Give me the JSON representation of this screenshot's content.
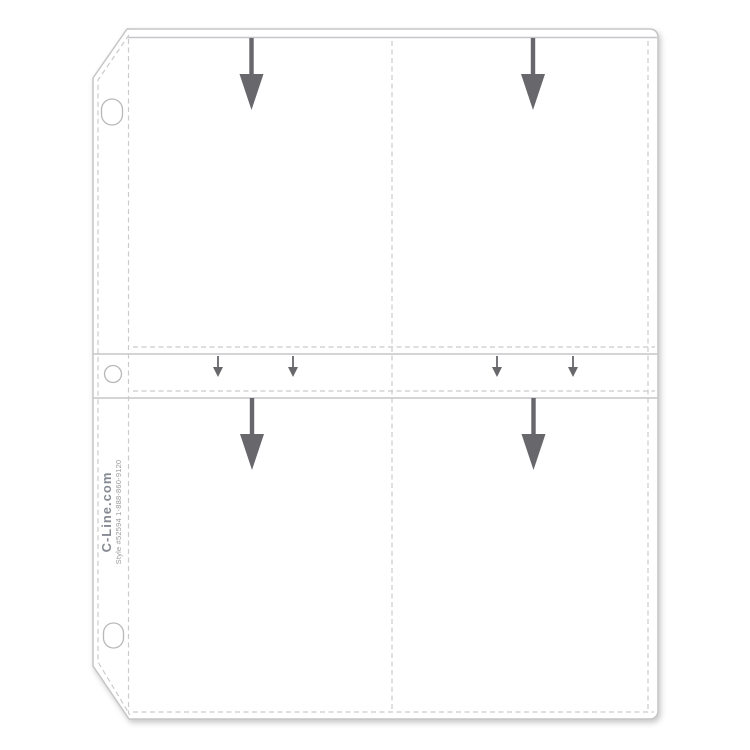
{
  "imprint": {
    "brand": "C-Line.com",
    "style": "Style #52594 1-888-860-9120"
  },
  "colors": {
    "background": "#ffffff",
    "sheet_fill": "#ffffff",
    "outline_gray": "#c6c6c9",
    "seam_dash_gray": "#cbcbcd",
    "arrow_gray": "#67676c",
    "hole_outline_gray": "#b8b8bc",
    "brand_text_gray": "#858a93",
    "style_text_gray": "#9a9a9e"
  },
  "icons": {
    "large_arrow": "insert-down-arrow-icon",
    "small_arrow": "small-insert-down-arrow-icon"
  }
}
